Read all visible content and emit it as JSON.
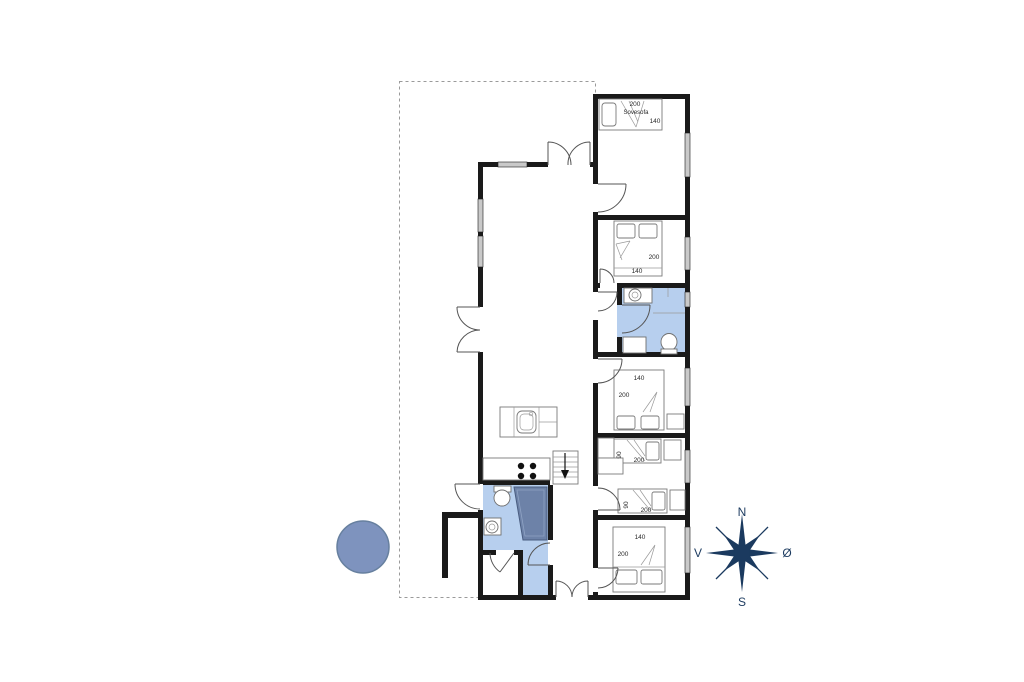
{
  "floorplan": {
    "bedroom_sofa": {
      "length": "200",
      "label": "Sovesofa",
      "width": "140"
    },
    "bedroom_top": {
      "length": "200",
      "width": "140"
    },
    "bedroom_mid": {
      "width": "140",
      "length": "200"
    },
    "kids_bed_a": {
      "width": "90",
      "length": "200"
    },
    "kids_bed_b": {
      "width": "90",
      "length": "200"
    },
    "bedroom_bottom": {
      "width": "140",
      "length": "200"
    }
  },
  "compass": {
    "north": "N",
    "east": "Ø",
    "south": "S",
    "west": "V"
  },
  "colors": {
    "wall": "#1a1a1a",
    "window": "#c9c9c9",
    "bathroom": "#b7cfee",
    "shower": "#6d82a8",
    "shower_edge": "#4a5d80",
    "marker_fill": "#7e93be",
    "marker_edge": "#67809f",
    "compass": "#1b3a5f",
    "terrace_dash": "#9a9a9a"
  }
}
